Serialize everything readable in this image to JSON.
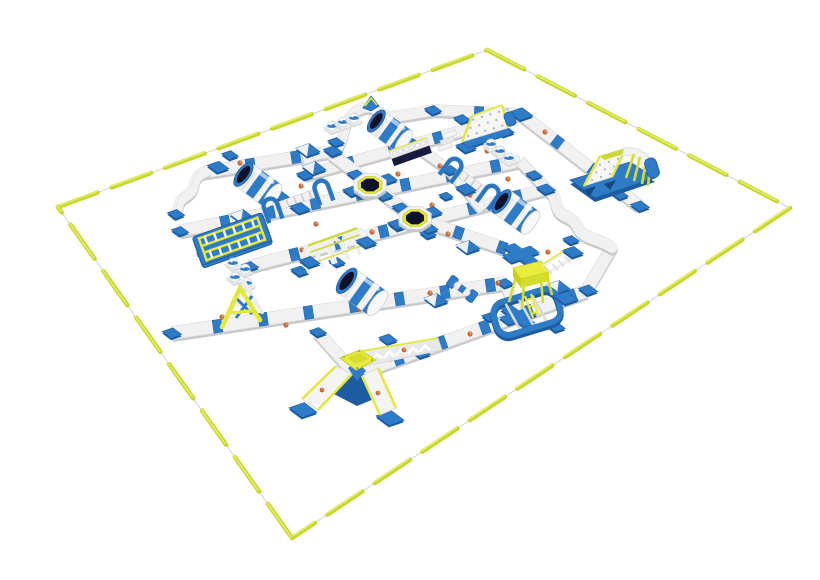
{
  "scene": {
    "name": "inflatable-floating-aqua-park-3d-layout",
    "background": "#ffffff",
    "width": 820,
    "height": 580
  },
  "colors": {
    "blue": "#2e7cc8",
    "blue_dark": "#1d5ca0",
    "blue_deep": "#14487e",
    "navy": "#10122c",
    "yellow": "#e3e83c",
    "yellow_dark": "#c6cf2a",
    "yellow_green": "#cdd92f",
    "buoy": "#c9d62c",
    "buoy_light": "#e8f070",
    "walk_top": "#f1f1f1",
    "walk_edge": "#dcdcdc",
    "walk_shadow": "#c6cacc",
    "white": "#ffffff",
    "dot_grey": "#b9bec2",
    "logo_orange": "#c2622f",
    "logo_orange_light": "#e8a06a"
  },
  "perimeter": {
    "corners": [
      [
        58,
        207
      ],
      [
        487,
        50
      ],
      [
        790,
        208
      ],
      [
        292,
        538
      ]
    ],
    "dash": 42,
    "gap": 15,
    "thickness": 4.5,
    "line_color": "#c8c8c8"
  },
  "walkways": [
    [
      205,
      172,
      333,
      151,
      12
    ],
    [
      433,
      110,
      521,
      114,
      11
    ],
    [
      305,
      175,
      521,
      114,
      11
    ],
    [
      180,
      231,
      520,
      161,
      12
    ],
    [
      250,
      266,
      546,
      189,
      12
    ],
    [
      305,
      148,
      312,
      173,
      10
    ],
    [
      332,
      154,
      415,
      218,
      12
    ],
    [
      415,
      218,
      521,
      254,
      12
    ],
    [
      412,
      143,
      450,
      170,
      10
    ],
    [
      450,
      170,
      483,
      210,
      10
    ],
    [
      521,
      114,
      640,
      206,
      12
    ],
    [
      520,
      161,
      548,
      190,
      11
    ],
    [
      612,
      247,
      586,
      291,
      12
    ],
    [
      355,
      374,
      586,
      291,
      13
    ],
    [
      172,
      333,
      505,
      283,
      13
    ],
    [
      505,
      283,
      518,
      316,
      11
    ],
    [
      521,
      254,
      542,
      271,
      10
    ],
    [
      318,
      332,
      355,
      374,
      12
    ]
  ],
  "scurves": [
    {
      "d": "M333,151 C348,142 338,116 362,108 C380,102 378,120 398,116 C415,113 424,112 433,110",
      "w": 11
    },
    {
      "d": "M205,172 C190,176 197,189 187,195 C177,201 179,205 176,213",
      "w": 11
    },
    {
      "d": "M548,190 C560,196 552,210 566,216 C582,223 574,231 590,237 C600,241 607,243 612,247",
      "w": 12
    }
  ],
  "connectors": [
    [
      218,
      167,
      10
    ],
    [
      333,
      151,
      9
    ],
    [
      305,
      175,
      8
    ],
    [
      176,
      214,
      8
    ],
    [
      180,
      231,
      8
    ],
    [
      433,
      110,
      8
    ],
    [
      521,
      114,
      11
    ],
    [
      412,
      143,
      8
    ],
    [
      450,
      170,
      8
    ],
    [
      546,
      189,
      9
    ],
    [
      640,
      206,
      9
    ],
    [
      588,
      290,
      9
    ],
    [
      172,
      333,
      9
    ],
    [
      250,
      266,
      8
    ],
    [
      318,
      332,
      8
    ],
    [
      505,
      283,
      8
    ]
  ],
  "side_squares": [
    [
      230,
      155,
      8
    ],
    [
      281,
      196,
      8
    ],
    [
      336,
      142,
      8
    ],
    [
      361,
      193,
      8
    ],
    [
      300,
      271,
      9
    ],
    [
      337,
      262,
      8
    ],
    [
      398,
      226,
      8
    ],
    [
      428,
      234,
      8
    ],
    [
      446,
      196,
      7
    ],
    [
      476,
      141,
      8
    ],
    [
      462,
      119,
      8
    ],
    [
      508,
      201,
      8
    ],
    [
      534,
      175,
      8
    ],
    [
      388,
      339,
      9
    ],
    [
      421,
      353,
      9
    ],
    [
      490,
      317,
      8
    ],
    [
      556,
      327,
      9
    ],
    [
      571,
      240,
      8
    ],
    [
      205,
      255,
      8
    ],
    [
      620,
      195,
      8
    ]
  ],
  "plus_connectors": [
    [
      521,
      254
    ],
    [
      518,
      316
    ]
  ],
  "ramps": [
    [
      308,
      150
    ],
    [
      314,
      168
    ],
    [
      242,
      216
    ],
    [
      468,
      247
    ],
    [
      436,
      300
    ],
    [
      558,
      287
    ]
  ],
  "logos": [
    [
      240,
      163
    ],
    [
      268,
      190
    ],
    [
      301,
      186
    ],
    [
      316,
      224
    ],
    [
      352,
      194
    ],
    [
      398,
      174
    ],
    [
      440,
      166
    ],
    [
      487,
      151
    ],
    [
      302,
      250
    ],
    [
      341,
      243
    ],
    [
      372,
      232
    ],
    [
      432,
      205
    ],
    [
      470,
      195
    ],
    [
      508,
      179
    ],
    [
      448,
      234
    ],
    [
      498,
      283
    ],
    [
      222,
      317
    ],
    [
      286,
      325
    ],
    [
      360,
      309
    ],
    [
      430,
      293
    ],
    [
      390,
      359
    ],
    [
      470,
      334
    ],
    [
      545,
      132
    ],
    [
      548,
      252
    ]
  ],
  "obstacles": [
    {
      "t": "minipeak",
      "x": 371,
      "y": 103,
      "name": "mini-climb-wedge"
    },
    {
      "t": "balls",
      "x": 343,
      "y": 122,
      "n": 3,
      "dir": "A",
      "name": "stepping-balls-top"
    },
    {
      "t": "climbwall",
      "x": 487,
      "y": 124,
      "name": "climbing-wall-peak"
    },
    {
      "t": "roller",
      "x": 390,
      "y": 131,
      "r": 13,
      "l": 34,
      "name": "roller-barrel-top"
    },
    {
      "t": "steps",
      "x": 446,
      "y": 146,
      "name": "step-podium"
    },
    {
      "t": "balancebox",
      "x": 410,
      "y": 151,
      "name": "balance-beam-box"
    },
    {
      "t": "balls",
      "x": 500,
      "y": 151,
      "n": 3,
      "dir": "B",
      "name": "stepping-balls-right"
    },
    {
      "t": "slide",
      "x": 604,
      "y": 168,
      "name": "slide-tower-right"
    },
    {
      "t": "roller",
      "x": 258,
      "y": 185,
      "r": 14,
      "l": 36,
      "name": "roller-barrel-left"
    },
    {
      "t": "tramp",
      "x": 370,
      "y": 185,
      "name": "trampoline-1"
    },
    {
      "t": "ladderbridge",
      "x": 466,
      "y": 189,
      "dir": "B",
      "len": 46,
      "name": "ladder-bridge-2"
    },
    {
      "t": "ladderbridge",
      "x": 300,
      "y": 208,
      "dir": "A",
      "len": 54,
      "name": "ladder-bridge-1"
    },
    {
      "t": "roller",
      "x": 516,
      "y": 212,
      "r": 14,
      "l": 36,
      "name": "roller-barrel-mid"
    },
    {
      "t": "tramp",
      "x": 415,
      "y": 218,
      "name": "trampoline-2"
    },
    {
      "t": "ladderclimb",
      "x": 232,
      "y": 239,
      "name": "double-ladder-climb"
    },
    {
      "t": "tunnel",
      "x": 338,
      "y": 252,
      "name": "arch-tunnel"
    },
    {
      "t": "balls",
      "x": 240,
      "y": 272,
      "n": 4,
      "dir": "S",
      "name": "stepping-balls-left"
    },
    {
      "t": "dumbbell",
      "x": 462,
      "y": 289,
      "name": "barrel-link"
    },
    {
      "t": "roller",
      "x": 362,
      "y": 292,
      "r": 15,
      "l": 38,
      "name": "roller-barrel-front"
    },
    {
      "t": "tower",
      "x": 531,
      "y": 293,
      "name": "play-tower"
    },
    {
      "t": "aframe",
      "x": 248,
      "y": 300,
      "name": "a-frame-climber"
    },
    {
      "t": "xslide",
      "x": 357,
      "y": 372,
      "name": "four-way-slide-mountain"
    }
  ]
}
